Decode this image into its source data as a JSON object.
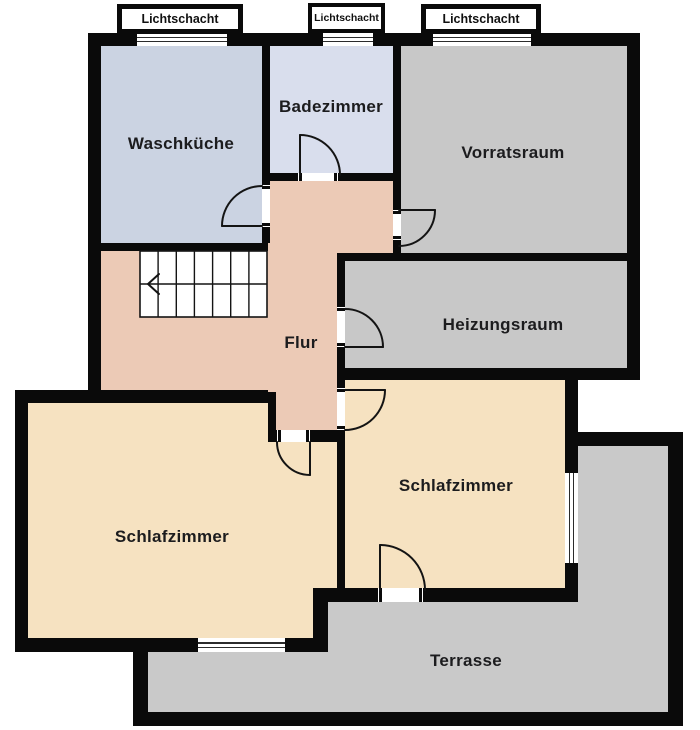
{
  "plan": {
    "rooms": {
      "waschkueche": {
        "label": "Waschküche"
      },
      "badezimmer": {
        "label": "Badezimmer"
      },
      "vorratsraum": {
        "label": "Vorratsraum"
      },
      "heizungsraum": {
        "label": "Heizungsraum"
      },
      "flur": {
        "label": "Flur"
      },
      "schlafzimmer_links": {
        "label": "Schlafzimmer"
      },
      "schlafzimmer_rechts": {
        "label": "Schlafzimmer"
      },
      "terrasse": {
        "label": "Terrasse"
      }
    },
    "light_shafts": {
      "left": {
        "label": "Lichtschacht"
      },
      "middle": {
        "label": "Lichtschacht"
      },
      "right": {
        "label": "Lichtschacht"
      }
    },
    "colors": {
      "wall": "#0a0a0a",
      "waschkueche": "#cbd3e2",
      "badezimmer": "#d9deed",
      "vorratsraum": "#c8c8c8",
      "heizungsraum": "#c8c8c8",
      "flur": "#eccab6",
      "schlafzimmer": "#f6e2c1",
      "terrasse": "#c9c9c9",
      "stairs": "#ffffff",
      "label_text": "#1c1c1e"
    }
  }
}
